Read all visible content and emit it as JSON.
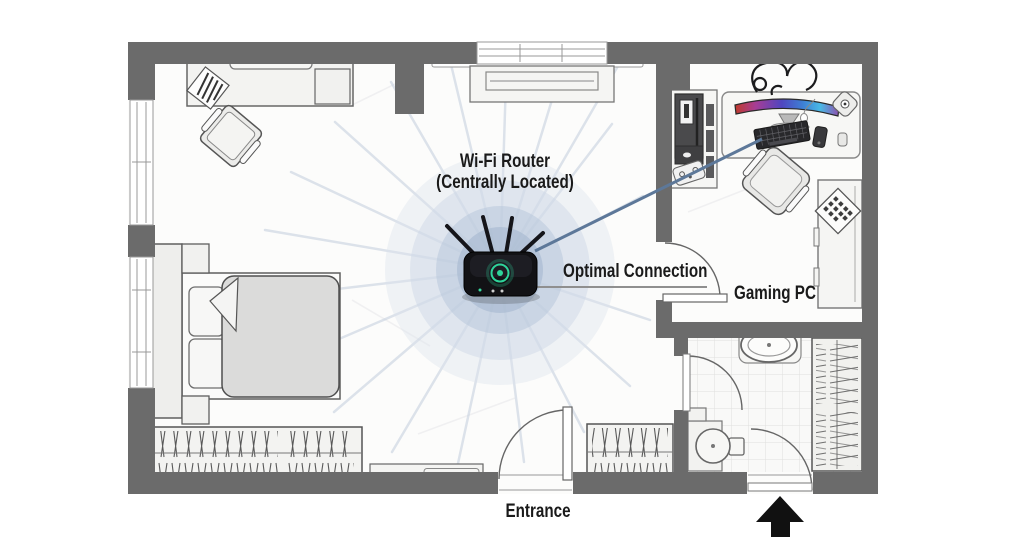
{
  "labels": {
    "router_title": "Wi-Fi Router",
    "router_subtitle": "(Centrally Located)",
    "optimal_connection": "Optimal Connection",
    "gaming_pc": "Gaming PC",
    "entrance": "Entrance"
  },
  "colors": {
    "wall": "#6b6b6b",
    "floor": "#fcfcfb",
    "signal_halo_core": "#a3b6ce",
    "signal_ray": "#c9d3e0",
    "connection_line": "#5d7899",
    "label_leader_line": "#8f8f8f",
    "router_body": "#121215",
    "router_led": "#2ed49a",
    "monitor_gradient": [
      "#c03a2b",
      "#a63d96",
      "#4f46c0",
      "#3e7fd4",
      "#49b9e6",
      "#8e4fae"
    ],
    "entrance_arrow": "#111111",
    "label_text": "#1a1a1a"
  },
  "icons": {
    "router": "wifi-router-icon",
    "entrance_arrow": "arrow-up-icon",
    "monitor": "curved-monitor-icon",
    "keyboard": "keyboard-icon",
    "signal": "wifi-signal-halo"
  }
}
